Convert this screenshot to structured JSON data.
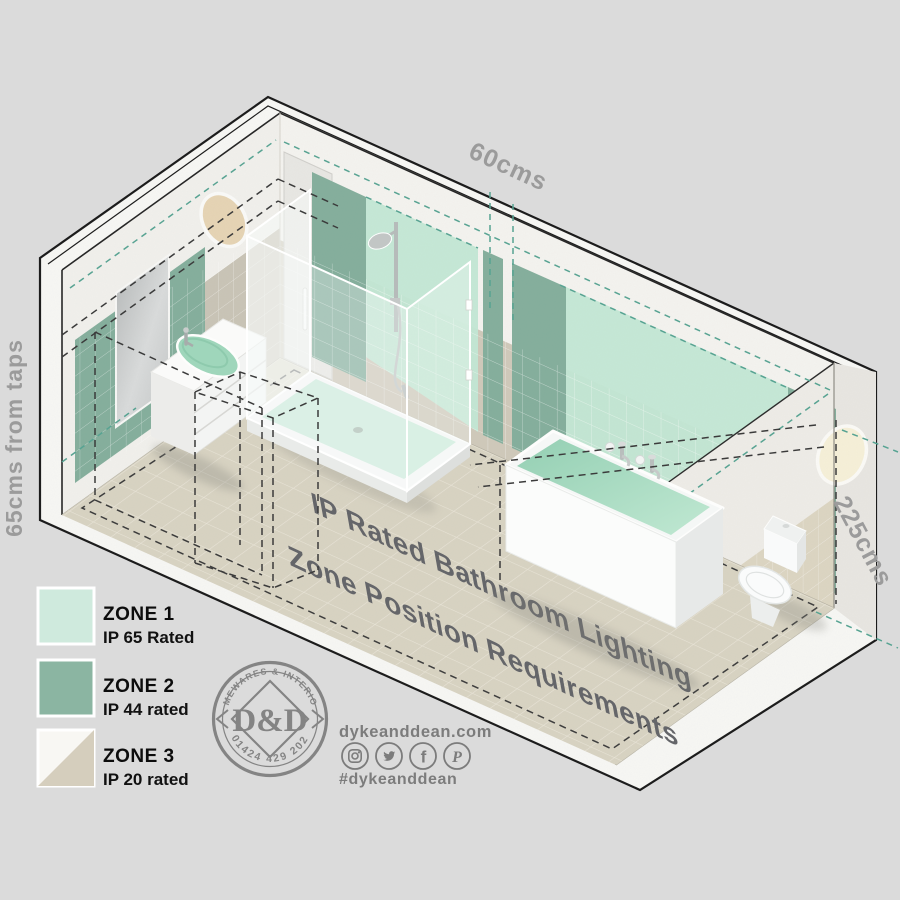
{
  "dimensions": {
    "shower_zone_width": "60cms",
    "basin_zone_distance": "65cms from taps",
    "zone_height": "225cms"
  },
  "floor_title": {
    "line1": "IP Rated Bathroom Lighting",
    "line2": "Zone Position Requirements"
  },
  "legend": {
    "items": [
      {
        "zone": "ZONE 1",
        "rating": "IP 65 Rated",
        "color": "#cfeadd"
      },
      {
        "zone": "ZONE 2",
        "rating": "IP 44 rated",
        "color": "#8bb5a2"
      },
      {
        "zone": "ZONE 3",
        "rating": "IP 20 rated",
        "color_top": "#f8f7f3",
        "color_bottom": "#d5cebd"
      }
    ]
  },
  "logo": {
    "arc_top": "HOMEWARES & INTERIORS",
    "monogram": "D&D",
    "arc_bottom": "01424 429 202"
  },
  "contact": {
    "website": "dykeanddean.com",
    "hashtag": "#dykeanddean",
    "social_icons": [
      "instagram",
      "twitter",
      "facebook",
      "pinterest"
    ]
  },
  "palette": {
    "zone1_mint": "#c3e7d4",
    "zone2_green": "#84ae9c",
    "teal_dash": "#56a392",
    "black_dash": "#3b3b3b",
    "background": "#dbdbdb"
  }
}
